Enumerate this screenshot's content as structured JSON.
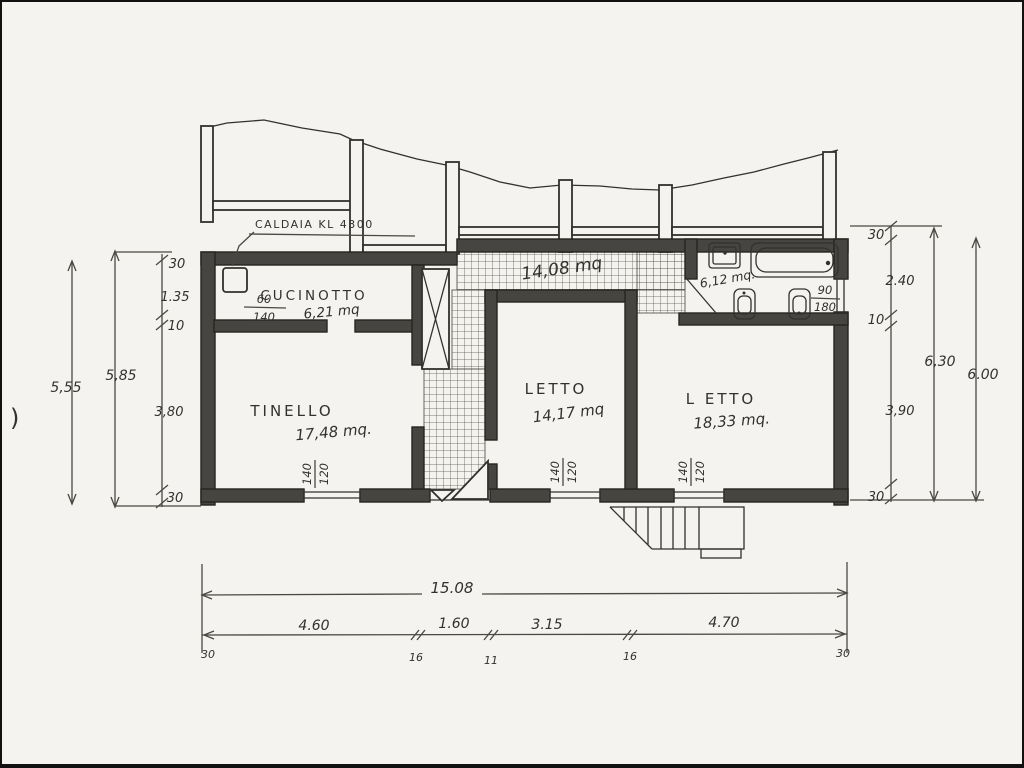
{
  "drawing": {
    "rooms": {
      "cucinotto": {
        "name": "CUCINOTTO",
        "area": "6,21 mq"
      },
      "tinello": {
        "name": "TINELLO",
        "area": "17,48 mq."
      },
      "letto1": {
        "name": "LETTO",
        "area": "14,17 mq"
      },
      "letto2": {
        "name": "L ETTO",
        "area": "18,33 mq."
      },
      "corridoio": {
        "area": "14,08 mq"
      },
      "bagno": {
        "area": "6,12 mq."
      }
    },
    "annotations": {
      "caldaia": "CALDAIA KL 4300",
      "caldaia_frac": {
        "top": "60",
        "bottom": "140"
      },
      "bath_window": {
        "top": "90",
        "bottom": "180"
      },
      "window_label": {
        "top": "140",
        "bottom": "120"
      },
      "stray": ")"
    },
    "dimensions": {
      "left": {
        "outer": "5,55",
        "inner": "5,85",
        "chain": [
          "30",
          "1.35",
          "10",
          "3,80",
          "30"
        ]
      },
      "right": {
        "chain": [
          "30",
          "2.40",
          "10",
          "3,90",
          "30"
        ],
        "inner_total": "6,30",
        "outer_total": "6.00"
      },
      "bottom": {
        "total": "15.08",
        "chain": [
          "4.60",
          "1.60",
          "3.15",
          "4.70"
        ],
        "ticks": [
          "30",
          "16",
          "11",
          "16",
          "30"
        ]
      }
    },
    "ink": "#33312e",
    "paper": "#f4f3ef"
  }
}
